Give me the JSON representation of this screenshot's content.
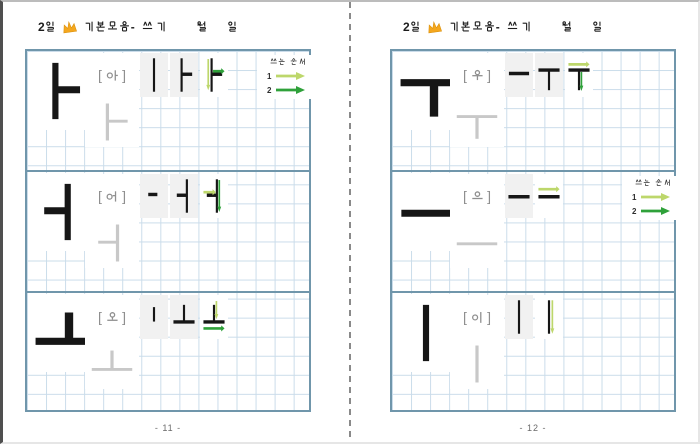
{
  "colors": {
    "arrow1": "#bdd76b",
    "arrow2": "#2fa13a",
    "ink": "#161616",
    "trace": "#c8c8c8",
    "grid": "#cadcea",
    "border": "#7096ab",
    "label": "#8f8f8f",
    "cell_bg": "#f1f1f1",
    "header_ink": "#1c1c1c",
    "crown": "#f4a71e"
  },
  "bracket_open": "[",
  "bracket_close": "]",
  "legend": {
    "title": "쓰는 순서",
    "items": [
      {
        "num": "1",
        "order": 1
      },
      {
        "num": "2",
        "order": 2
      }
    ]
  },
  "pages": [
    {
      "side": "left",
      "header": {
        "day": "2일",
        "title": "기본모음- 쓰기",
        "month_label": "월",
        "day_label": "일"
      },
      "page_number": "- 11 -",
      "sections": [
        {
          "name": "a",
          "syllable": "아",
          "vowel_glyph": "a",
          "wide": false,
          "legend": true,
          "steps": [
            {
              "glyph": "v",
              "arrows": []
            },
            {
              "glyph": "a",
              "arrows": []
            },
            {
              "glyph": "a",
              "arrows": [
                {
                  "dir": "down",
                  "order": 1,
                  "pos": 26,
                  "from": 8,
                  "to": 90
                },
                {
                  "dir": "right",
                  "order": 2,
                  "pos": 40,
                  "from": 46,
                  "to": 94
                }
              ]
            }
          ]
        },
        {
          "name": "eo",
          "syllable": "어",
          "vowel_glyph": "eo",
          "wide": false,
          "legend": false,
          "steps": [
            {
              "glyph": "tick",
              "arrows": []
            },
            {
              "glyph": "eo",
              "arrows": []
            },
            {
              "glyph": "eo",
              "arrows": [
                {
                  "dir": "right",
                  "order": 1,
                  "pos": 40,
                  "from": 6,
                  "to": 58
                },
                {
                  "dir": "down",
                  "order": 2,
                  "pos": 72,
                  "from": 8,
                  "to": 92
                }
              ]
            }
          ]
        },
        {
          "name": "o",
          "syllable": "오",
          "vowel_glyph": "o",
          "wide": true,
          "legend": false,
          "steps": [
            {
              "glyph": "sv",
              "arrows": []
            },
            {
              "glyph": "o",
              "arrows": []
            },
            {
              "glyph": "o",
              "arrows": [
                {
                  "dir": "down",
                  "order": 1,
                  "pos": 60,
                  "from": 8,
                  "to": 56
                },
                {
                  "dir": "right",
                  "order": 2,
                  "pos": 80,
                  "from": 6,
                  "to": 94
                }
              ]
            }
          ]
        }
      ]
    },
    {
      "side": "right",
      "header": {
        "day": "2일",
        "title": "기본모음- 쓰기",
        "month_label": "월",
        "day_label": "일"
      },
      "page_number": "- 12 -",
      "sections": [
        {
          "name": "u",
          "syllable": "우",
          "vowel_glyph": "u",
          "wide": true,
          "legend": false,
          "steps": [
            {
              "glyph": "hmid",
              "arrows": []
            },
            {
              "glyph": "u",
              "arrows": []
            },
            {
              "glyph": "u",
              "arrows": [
                {
                  "dir": "right",
                  "order": 1,
                  "pos": 22,
                  "from": 6,
                  "to": 94
                },
                {
                  "dir": "down",
                  "order": 2,
                  "pos": 60,
                  "from": 42,
                  "to": 92
                }
              ]
            }
          ]
        },
        {
          "name": "eu",
          "syllable": "으",
          "vowel_glyph": "eu",
          "wide": false,
          "legend": true,
          "steps": [
            {
              "glyph": "eu",
              "arrows": []
            },
            {
              "glyph": "eu",
              "arrows": [
                {
                  "dir": "right",
                  "order": 1,
                  "pos": 32,
                  "from": 6,
                  "to": 94
                }
              ]
            }
          ]
        },
        {
          "name": "i",
          "syllable": "이",
          "vowel_glyph": "i",
          "wide": false,
          "legend": false,
          "steps": [
            {
              "glyph": "i",
              "arrows": []
            },
            {
              "glyph": "i",
              "arrows": [
                {
                  "dir": "down",
                  "order": 1,
                  "pos": 64,
                  "from": 6,
                  "to": 94
                }
              ]
            }
          ]
        }
      ]
    }
  ]
}
